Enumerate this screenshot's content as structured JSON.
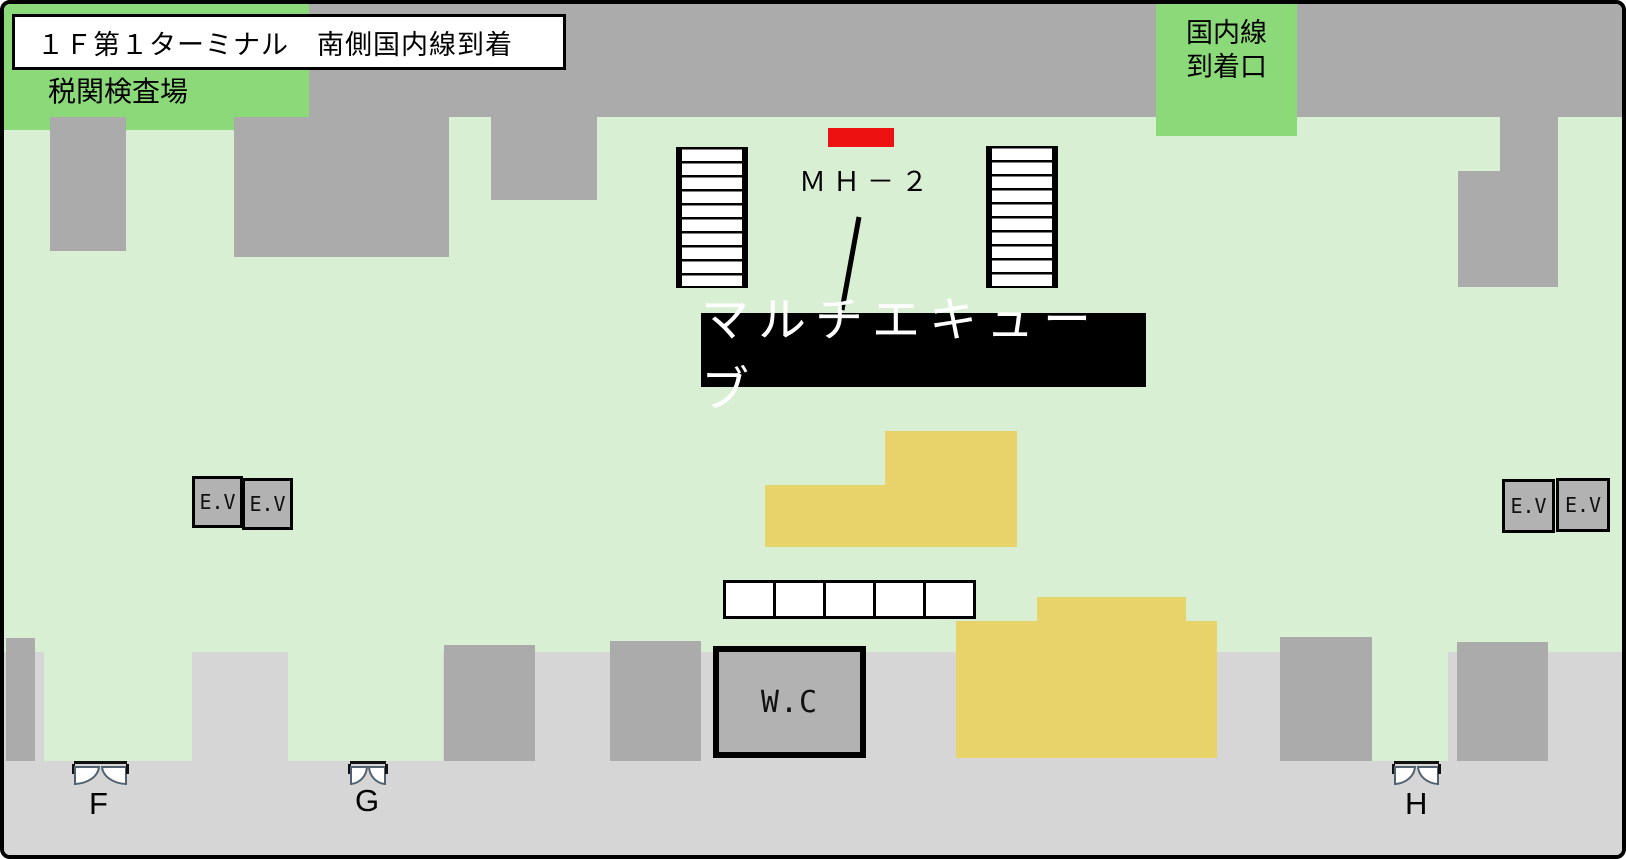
{
  "header": {
    "title": "１Ｆ第１ターミナル　南側国内線到着",
    "customs_area_label": "税関検査場",
    "arrival_gate": {
      "line1": "国内線",
      "line2": "到着口"
    }
  },
  "marker": {
    "code": "ＭＨ－２",
    "label": "マルチエキューブ"
  },
  "elevators": {
    "labels": [
      "E.V",
      "E.V",
      "E.V",
      "E.V"
    ]
  },
  "toilet": {
    "label": "W.C"
  },
  "exits": {
    "f": "F",
    "g": "G",
    "h": "H"
  },
  "colors": {
    "floor_green": "#d9efd3",
    "highlight_green": "#8cd97a",
    "corridor_gray": "#ababab",
    "walkway_gray": "#d6d6d6",
    "bench_yellow": "#e8d36a",
    "marker_red": "#ee1111"
  }
}
